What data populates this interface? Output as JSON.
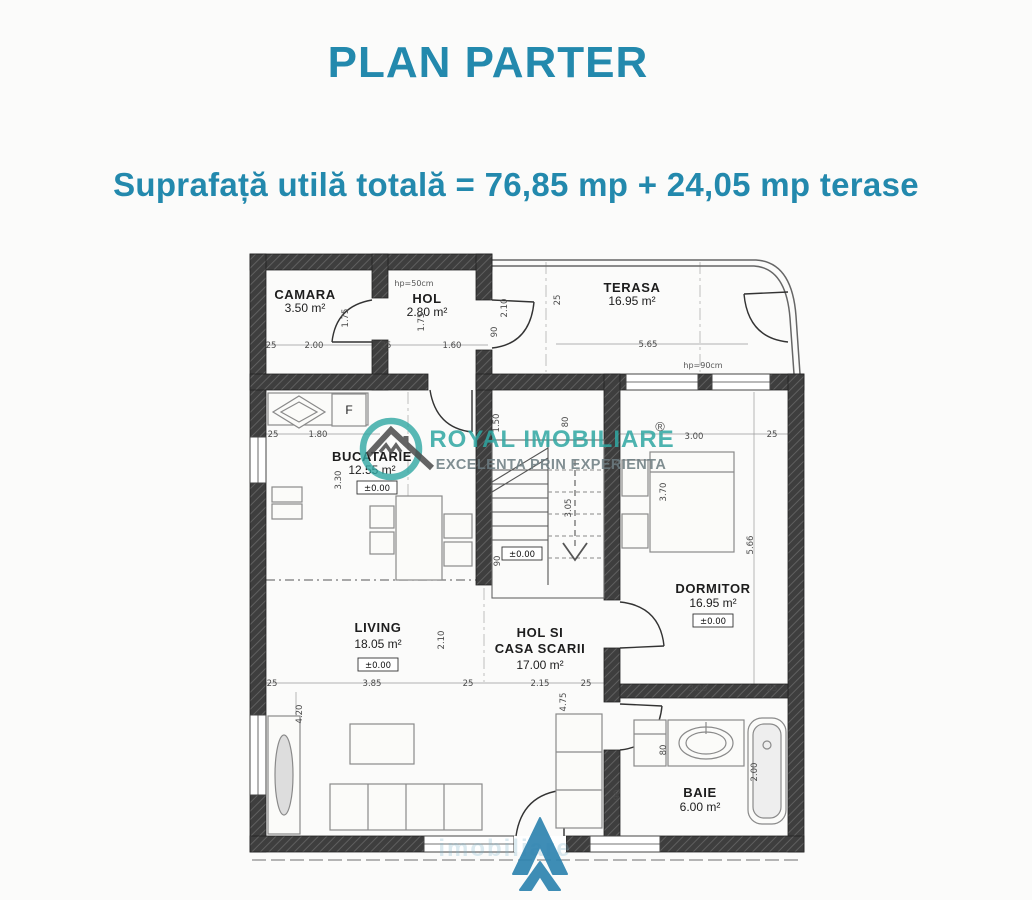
{
  "header": {
    "title": "PLAN PARTER",
    "subtitle": "Suprafață utilă totală = 76,85 mp + 24,05 mp terase",
    "accent_color": "#2389ad"
  },
  "watermark": {
    "brand": "ROYAL IMOBILIARE",
    "tagline": "EXCELENTA PRIN EXPERIENTA",
    "registered": "®",
    "faint": "imobiliare",
    "logo": "house-in-circle-icon",
    "color": "#2fa7a2"
  },
  "footer_logo": {
    "name": "arrow-a-icon",
    "color": "#2f84b0"
  },
  "plan": {
    "level_label": "±0.00",
    "fridge_label": "F",
    "rooms": [
      {
        "id": "camara",
        "name": "CAMARA",
        "area": "3.50 m²",
        "nx": 305,
        "ny": 299,
        "ax": 305,
        "ay": 312
      },
      {
        "id": "hol",
        "name": "HOL",
        "area": "2.80 m²",
        "nx": 427,
        "ny": 303,
        "ax": 427,
        "ay": 316
      },
      {
        "id": "terasa",
        "name": "TERASA",
        "area": "16.95 m²",
        "nx": 632,
        "ny": 292,
        "ax": 632,
        "ay": 305
      },
      {
        "id": "bucatarie",
        "name": "BUCATARIE",
        "area": "12.55 m²",
        "nx": 372,
        "ny": 461,
        "ax": 372,
        "ay": 474
      },
      {
        "id": "dormitor",
        "name": "DORMITOR",
        "area": "16.95 m²",
        "nx": 713,
        "ny": 593,
        "ax": 713,
        "ay": 607
      },
      {
        "id": "living",
        "name": "LIVING",
        "area": "18.05 m²",
        "nx": 378,
        "ny": 632,
        "ax": 378,
        "ay": 648
      },
      {
        "id": "hol-casa-scarii",
        "name": "HOL SI",
        "name2": "CASA SCARII",
        "area": "17.00 m²",
        "nx": 540,
        "ny": 637,
        "n2x": 540,
        "n2y": 653,
        "ax": 540,
        "ay": 669
      },
      {
        "id": "baie",
        "name": "BAIE",
        "area": "6.00 m²",
        "nx": 700,
        "ny": 797,
        "ax": 700,
        "ay": 811
      }
    ],
    "level_markers": [
      {
        "x": 377,
        "y": 487
      },
      {
        "x": 522,
        "y": 553
      },
      {
        "x": 713,
        "y": 620
      },
      {
        "x": 378,
        "y": 664
      }
    ],
    "annotations": [
      {
        "t": "hp=50cm",
        "x": 414,
        "y": 286
      },
      {
        "t": "hp=90cm",
        "x": 703,
        "y": 368
      }
    ],
    "dimensions": [
      {
        "t": "25",
        "x": 271,
        "y": 348
      },
      {
        "t": "2.00",
        "x": 314,
        "y": 348
      },
      {
        "t": "25",
        "x": 386,
        "y": 348
      },
      {
        "t": "1.60",
        "x": 452,
        "y": 348
      },
      {
        "t": "1.75",
        "x": 348,
        "y": 318,
        "r": 1
      },
      {
        "t": "1.75",
        "x": 424,
        "y": 322,
        "r": 1
      },
      {
        "t": "90",
        "x": 497,
        "y": 332,
        "r": 1
      },
      {
        "t": "2.10",
        "x": 507,
        "y": 308,
        "r": 1
      },
      {
        "t": "5.65",
        "x": 648,
        "y": 347
      },
      {
        "t": "25",
        "x": 560,
        "y": 300,
        "r": 1
      },
      {
        "t": "25",
        "x": 273,
        "y": 437
      },
      {
        "t": "1.80",
        "x": 318,
        "y": 437
      },
      {
        "t": "3.30",
        "x": 341,
        "y": 480,
        "r": 1
      },
      {
        "t": "1.50",
        "x": 499,
        "y": 423,
        "r": 1
      },
      {
        "t": "80",
        "x": 568,
        "y": 422,
        "r": 1
      },
      {
        "t": "3.05",
        "x": 571,
        "y": 508,
        "r": 1
      },
      {
        "t": "90",
        "x": 500,
        "y": 561,
        "r": 1
      },
      {
        "t": "3.00",
        "x": 694,
        "y": 439
      },
      {
        "t": "25",
        "x": 772,
        "y": 437
      },
      {
        "t": "3.70",
        "x": 666,
        "y": 492,
        "r": 1
      },
      {
        "t": "5.66",
        "x": 753,
        "y": 545,
        "r": 1
      },
      {
        "t": "25",
        "x": 272,
        "y": 686
      },
      {
        "t": "3.85",
        "x": 372,
        "y": 686
      },
      {
        "t": "25",
        "x": 468,
        "y": 686
      },
      {
        "t": "2.15",
        "x": 540,
        "y": 686
      },
      {
        "t": "25",
        "x": 586,
        "y": 686
      },
      {
        "t": "2.10",
        "x": 444,
        "y": 640,
        "r": 1
      },
      {
        "t": "4.75",
        "x": 566,
        "y": 702,
        "r": 1
      },
      {
        "t": "4.20",
        "x": 302,
        "y": 714,
        "r": 1
      },
      {
        "t": "3.00",
        "x": 698,
        "y": 691
      },
      {
        "t": "25",
        "x": 772,
        "y": 691
      },
      {
        "t": "2.00",
        "x": 757,
        "y": 772,
        "r": 1
      },
      {
        "t": "80",
        "x": 666,
        "y": 750,
        "r": 1
      },
      {
        "t": "90",
        "x": 620,
        "y": 795,
        "r": 1
      }
    ]
  }
}
